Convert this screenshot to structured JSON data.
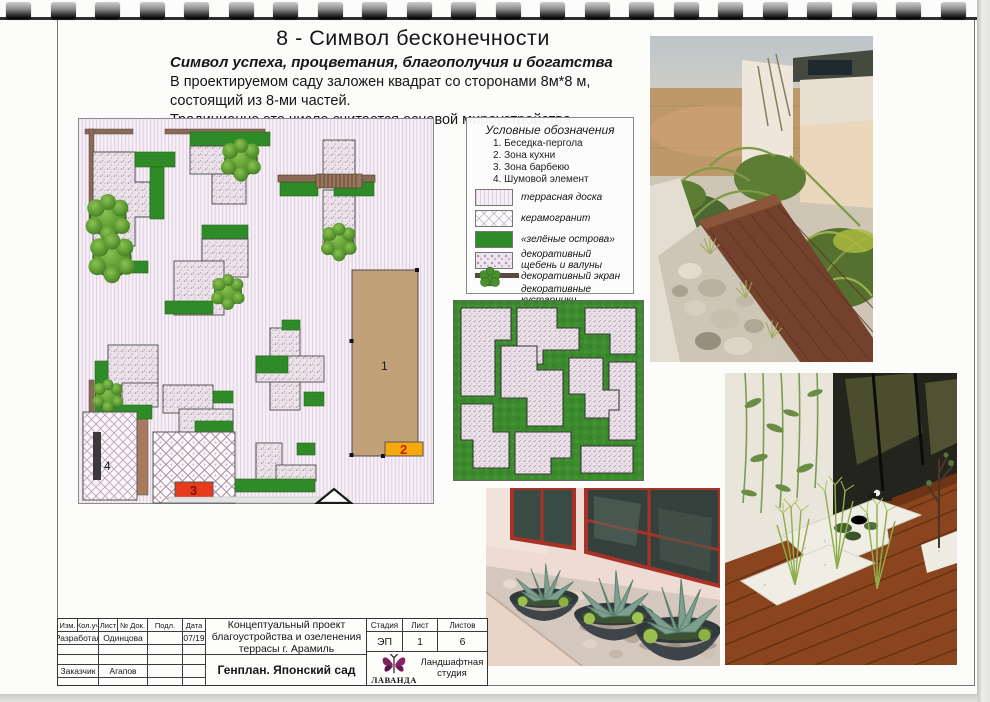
{
  "document": {
    "title": "8 - Символ бесконечности",
    "subtitle": "Символ успеха, процветания, благополучия и богатства",
    "description": [
      "В проектируемом саду заложен квадрат со сторонами 8м*8 м,",
      "состоящий из 8-ми частей.",
      "Традиционно это число считается основой мироустройства."
    ]
  },
  "legend": {
    "title": "Условные обозначения",
    "zones": [
      "1. Беседка-пергола",
      "2. Зона кухни",
      "3. Зона барбекю",
      "4. Шумовой элемент"
    ],
    "materials": [
      {
        "label": "террасная доска"
      },
      {
        "label": "керамогранит"
      },
      {
        "label": "«зелёные острова»"
      },
      {
        "label": "декоративный щебень и валуны"
      },
      {
        "label": "декоративный экран"
      },
      {
        "label": "декоративные кустарники"
      }
    ]
  },
  "plan": {
    "markers": {
      "pergola": "1",
      "kitchen": "2",
      "bbq": "3",
      "noise": "4"
    }
  },
  "title_block": {
    "columns": [
      "Изм.",
      "Кол.уч",
      "Лист",
      "№ Док.",
      "Подл.",
      "Дата"
    ],
    "developed_label": "Разработал",
    "developed_by": "Одинцова",
    "date": "07/19",
    "client_label": "Заказчик",
    "client_name": "Агапов",
    "project_name": "Концептуальный проект благоустройства и озеленения террасы г. Арамиль",
    "drawing_name": "Генплан. Японский сад",
    "stage_col": "Стадия",
    "sheet_col": "Лист",
    "sheets_col": "Листов",
    "stage": "ЭП",
    "sheet_no": "1",
    "sheets_total": "6",
    "studio_name": "ЛАВАНДА",
    "studio_caption": "Ландшафтная студия"
  },
  "colors": {
    "island_green": "#2f8a28",
    "pergola_tan": "#c2a179",
    "kitchen_orange": "#f5a90a",
    "bbq_red": "#e83a1c",
    "logo_magenta": "#7c2263"
  }
}
